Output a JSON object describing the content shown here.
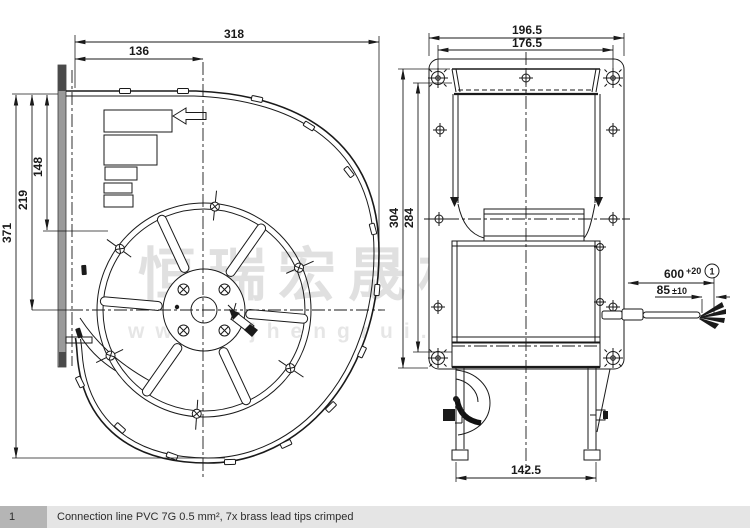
{
  "watermark": {
    "brand": "恒瑞宏晟机电",
    "url": "www.bjhengrui.cn"
  },
  "left_view": {
    "dims": {
      "overall_width": "318",
      "flange_to_center": "136",
      "overall_height": "371",
      "center_height": "219",
      "upper_height": "148"
    }
  },
  "right_view": {
    "dims": {
      "flange_width": "196.5",
      "hole_spacing": "176.5",
      "overall_height": "304",
      "inner_height": "284",
      "outlet_width": "142.5",
      "lead_length": "600",
      "lead_length_tol": "+20",
      "strip_length": "85",
      "strip_tol": "±10",
      "callout": "1"
    }
  },
  "footer": {
    "index": "1",
    "note": "Connection line PVC 7G 0.5 mm², 7x brass lead tips crimped"
  },
  "colors": {
    "line": "#1a1a1a",
    "watermark": "#cdcdcd",
    "footer_band": "#e5e5e5",
    "footer_cell": "#b5b5b5"
  }
}
